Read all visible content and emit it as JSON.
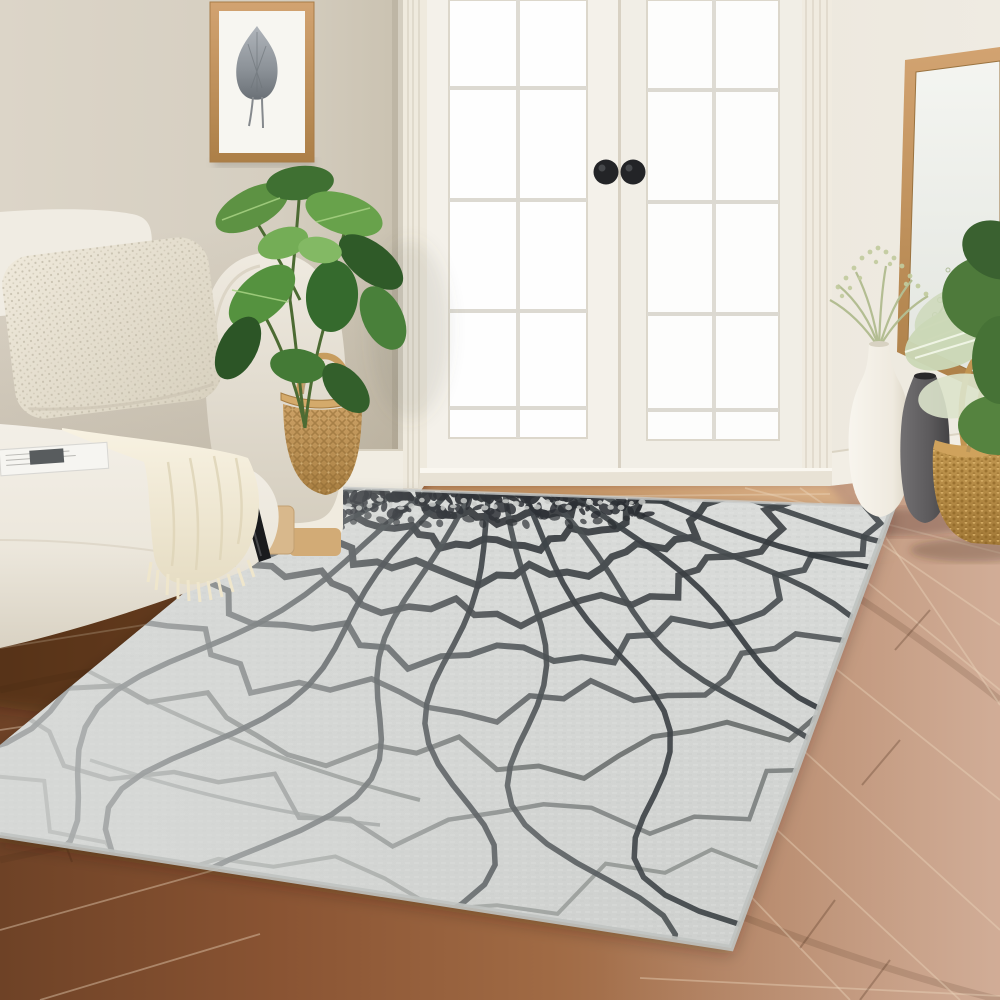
{
  "meta": {
    "title": "Living room scene with light gray crackle-pattern area rug",
    "kind": "photograph",
    "visible_text": "none"
  },
  "palette": {
    "wall_left": "#d7d0c2",
    "wall_right": "#eae5da",
    "trim_white": "#f3efe7",
    "door_glass": "#ffffff",
    "knob_black": "#232427",
    "floor_dark": "#6e4226",
    "floor_mid": "#9b6943",
    "floor_light": "#c79f85",
    "rug_base": "#d7d9d7",
    "rug_crack_dark": "#2b2f33",
    "rug_crack_mid": "#4a4f52",
    "rug_crack_light": "#8e928f",
    "sofa_cream": "#efebe2",
    "pillow": "#e9e3d5",
    "throw": "#f4eedd",
    "plant_green": "#4e7e3c",
    "basket_tan": "#c49a5e",
    "mirror_frame": "#c4935f",
    "vase_white": "#f3efe6",
    "vase_gray": "#5c5a5c",
    "art_frame_wood": "#c9a06f",
    "art_leaf_gray": "#7b8187"
  },
  "scene": {
    "objects": [
      {
        "name": "framed-leaf-art",
        "label": "Framed gray leaf print in a light wood frame"
      },
      {
        "name": "french-doors",
        "label": "White French doors with divided glass panes and two black round knobs"
      },
      {
        "name": "sofa",
        "label": "Cream upholstered sofa with knit pillow, throw blanket and open magazine"
      },
      {
        "name": "potted-plant",
        "label": "Green rubber plant beside the sofa"
      },
      {
        "name": "woven-basket-left",
        "label": "Woven seagrass basket with handle"
      },
      {
        "name": "leaning-mirror",
        "label": "Wood-framed mirror leaning on the right wall"
      },
      {
        "name": "white-vase",
        "label": "Tall white vase with dried sage sprigs"
      },
      {
        "name": "gray-vase",
        "label": "Charcoal gray vase"
      },
      {
        "name": "woven-basket-right",
        "label": "Woven basket planter with large green leaves"
      },
      {
        "name": "area-rug",
        "label": "Light gray area rug with dark charcoal crackle web pattern"
      },
      {
        "name": "wood-floor",
        "label": "Warm brown hardwood plank floor"
      }
    ],
    "rug": {
      "web": {
        "cx": 497,
        "cy": 438,
        "squash": 0.55,
        "angle_start": -2,
        "angle_end": 184,
        "arcs": [
          {
            "r": 70,
            "w": 8,
            "c": "#272b2f"
          },
          {
            "r": 104,
            "w": 7.5,
            "c": "#2b2f33"
          },
          {
            "r": 146,
            "w": 7.5,
            "c": "#2f3337"
          },
          {
            "r": 194,
            "w": 7,
            "c": "#34383c"
          },
          {
            "r": 252,
            "w": 7,
            "c": "#3b4043"
          },
          {
            "r": 320,
            "w": 6.5,
            "c": "#42474a"
          },
          {
            "r": 398,
            "w": 6,
            "c": "#4c5154"
          },
          {
            "r": 486,
            "w": 5.5,
            "c": "#585d5f"
          },
          {
            "r": 588,
            "w": 5,
            "c": "#686d6c"
          },
          {
            "r": 700,
            "w": 4.5,
            "c": "#7b807e"
          },
          {
            "r": 825,
            "w": 4,
            "c": "#8e928f"
          }
        ],
        "radials": {
          "count": 18,
          "aStart": 3,
          "aEnd": 177,
          "r0": 56,
          "r1": 980,
          "w": 5.5,
          "c": "#343a3e",
          "c2": "#41464a"
        },
        "band": {
          "x0": 332,
          "x1": 648,
          "y": 487,
          "blob_color": "#22262b",
          "speck_color": "#c7c9c7"
        }
      }
    }
  }
}
